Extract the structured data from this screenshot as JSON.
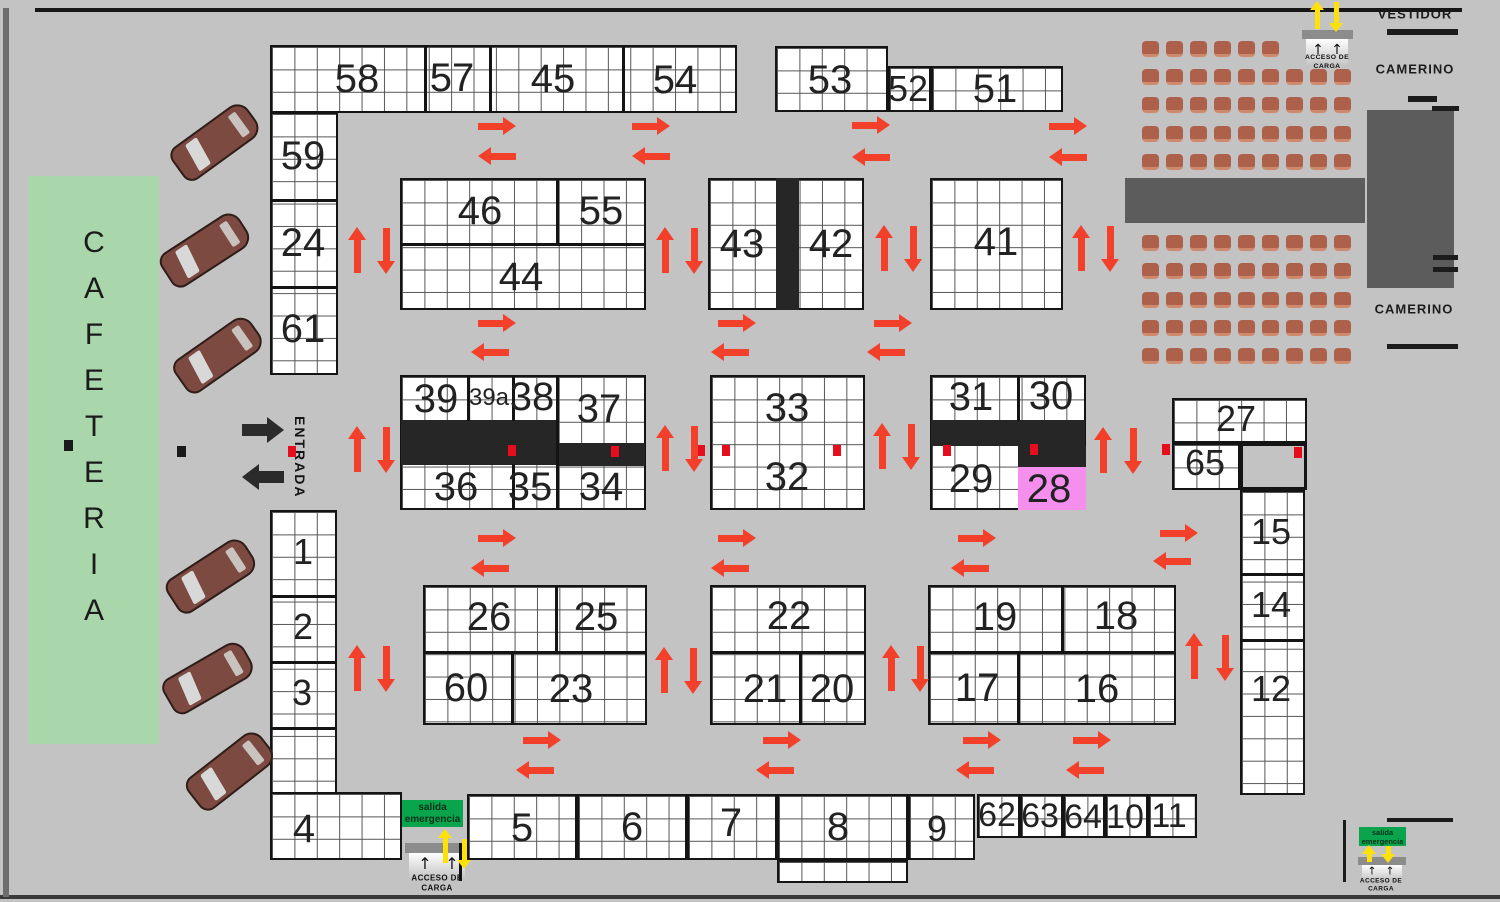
{
  "labels": {
    "cafeteria": "CAFETERIA",
    "entrance": "ENTRADA",
    "vestidor": "VESTIDOR",
    "camerino_top": "CAMERINO",
    "camerino_bottom": "CAMERINO",
    "exit_line1": "salida",
    "exit_line2": "emergencia",
    "loading_line1": "ACCESO DE",
    "loading_line2": "CARGA"
  },
  "colors": {
    "background": "#c3c3c3",
    "grid_cell": "#ffffff",
    "grid_line": "#565656",
    "block_border": "#141414",
    "black_bar": "#262626",
    "stall_28": "#f58fee",
    "aisle_arrow": "#f2402b",
    "marker_red": "#e60e1c",
    "marker_black": "#1a1a1a",
    "exit_sign": "#0aa44d",
    "exit_arrow": "#ffe10a",
    "cafeteria": "#a9d6aa",
    "chair": "#ae614a",
    "stage": "#5c5c5c"
  },
  "plan": {
    "blocks": [
      [
        270,
        45,
        467,
        68
      ],
      [
        270,
        112,
        68,
        263
      ],
      [
        775,
        46,
        113,
        66
      ],
      [
        888,
        66,
        43,
        46
      ],
      [
        931,
        66,
        132,
        46
      ],
      [
        400,
        178,
        246,
        132
      ],
      [
        708,
        178,
        156,
        132
      ],
      [
        930,
        178,
        133,
        132
      ],
      [
        400,
        375,
        246,
        135
      ],
      [
        710,
        375,
        155,
        135
      ],
      [
        930,
        375,
        156,
        135
      ],
      [
        1172,
        398,
        135,
        45
      ],
      [
        1172,
        443,
        68,
        47
      ],
      [
        1240,
        490,
        65,
        305
      ],
      [
        270,
        510,
        67,
        284
      ],
      [
        270,
        792,
        132,
        68
      ],
      [
        423,
        585,
        224,
        140
      ],
      [
        710,
        585,
        156,
        140
      ],
      [
        928,
        585,
        248,
        140
      ],
      [
        467,
        794,
        110,
        66
      ],
      [
        577,
        794,
        110,
        66
      ],
      [
        687,
        794,
        90,
        66
      ],
      [
        777,
        794,
        131,
        66
      ],
      [
        777,
        860,
        131,
        23
      ],
      [
        908,
        794,
        67,
        66
      ],
      [
        977,
        794,
        43,
        44
      ],
      [
        1020,
        794,
        43,
        44
      ],
      [
        1063,
        794,
        42,
        44
      ],
      [
        1105,
        794,
        43,
        44
      ],
      [
        1148,
        794,
        49,
        44
      ]
    ],
    "gray_blocks": [
      [
        1240,
        443,
        67,
        47
      ]
    ],
    "solids": [
      [
        776,
        178,
        23,
        132
      ],
      [
        401,
        420,
        156,
        45
      ],
      [
        557,
        443,
        88,
        23
      ],
      [
        931,
        420,
        154,
        26
      ],
      [
        1018,
        446,
        68,
        21
      ]
    ],
    "pinks": [
      [
        1018,
        467,
        68,
        43
      ]
    ],
    "dividers": [
      [
        424,
        45,
        3,
        68
      ],
      [
        489,
        45,
        3,
        68
      ],
      [
        622,
        45,
        3,
        68
      ],
      [
        270,
        199,
        68,
        3
      ],
      [
        270,
        286,
        68,
        3
      ],
      [
        556,
        178,
        3,
        67
      ],
      [
        400,
        243,
        246,
        3
      ],
      [
        467,
        375,
        3,
        46
      ],
      [
        512,
        375,
        3,
        46
      ],
      [
        556,
        375,
        3,
        135
      ],
      [
        512,
        464,
        3,
        46
      ],
      [
        1017,
        375,
        3,
        46
      ],
      [
        1240,
        573,
        65,
        3
      ],
      [
        1240,
        639,
        65,
        3
      ],
      [
        270,
        595,
        67,
        3
      ],
      [
        270,
        661,
        67,
        3
      ],
      [
        270,
        727,
        67,
        3
      ],
      [
        423,
        651,
        224,
        3
      ],
      [
        555,
        585,
        3,
        67
      ],
      [
        511,
        651,
        3,
        74
      ],
      [
        710,
        651,
        156,
        3
      ],
      [
        799,
        651,
        3,
        74
      ],
      [
        928,
        651,
        248,
        3
      ],
      [
        1061,
        585,
        3,
        67
      ],
      [
        1017,
        651,
        3,
        74
      ]
    ],
    "stalls": [
      {
        "n": "58",
        "x": 357,
        "y": 79
      },
      {
        "n": "57",
        "x": 452,
        "y": 78
      },
      {
        "n": "45",
        "x": 553,
        "y": 79
      },
      {
        "n": "54",
        "x": 675,
        "y": 80
      },
      {
        "n": "53",
        "x": 830,
        "y": 80
      },
      {
        "n": "52",
        "x": 908,
        "y": 89,
        "s": 36
      },
      {
        "n": "51",
        "x": 995,
        "y": 89
      },
      {
        "n": "59",
        "x": 303,
        "y": 156
      },
      {
        "n": "24",
        "x": 303,
        "y": 243
      },
      {
        "n": "61",
        "x": 303,
        "y": 329
      },
      {
        "n": "46",
        "x": 480,
        "y": 211
      },
      {
        "n": "55",
        "x": 601,
        "y": 211
      },
      {
        "n": "44",
        "x": 521,
        "y": 277
      },
      {
        "n": "43",
        "x": 742,
        "y": 244
      },
      {
        "n": "42",
        "x": 831,
        "y": 244
      },
      {
        "n": "41",
        "x": 996,
        "y": 242
      },
      {
        "n": "39",
        "x": 436,
        "y": 399
      },
      {
        "n": "39a",
        "x": 489,
        "y": 398,
        "s": 24
      },
      {
        "n": "38",
        "x": 532,
        "y": 397
      },
      {
        "n": "37",
        "x": 599,
        "y": 409
      },
      {
        "n": "36",
        "x": 456,
        "y": 487
      },
      {
        "n": "35",
        "x": 530,
        "y": 487
      },
      {
        "n": "34",
        "x": 601,
        "y": 487
      },
      {
        "n": "33",
        "x": 787,
        "y": 408
      },
      {
        "n": "32",
        "x": 787,
        "y": 477
      },
      {
        "n": "31",
        "x": 971,
        "y": 397
      },
      {
        "n": "30",
        "x": 1051,
        "y": 396
      },
      {
        "n": "29",
        "x": 971,
        "y": 479
      },
      {
        "n": "28",
        "x": 1049,
        "y": 489
      },
      {
        "n": "27",
        "x": 1236,
        "y": 419,
        "s": 36
      },
      {
        "n": "65",
        "x": 1205,
        "y": 463,
        "s": 36
      },
      {
        "n": "15",
        "x": 1271,
        "y": 532,
        "s": 36
      },
      {
        "n": "14",
        "x": 1271,
        "y": 605,
        "s": 36
      },
      {
        "n": "12",
        "x": 1271,
        "y": 689,
        "s": 36
      },
      {
        "n": "1",
        "x": 303,
        "y": 552,
        "s": 36
      },
      {
        "n": "2",
        "x": 303,
        "y": 627,
        "s": 36
      },
      {
        "n": "3",
        "x": 302,
        "y": 693,
        "s": 36
      },
      {
        "n": "4",
        "x": 304,
        "y": 829
      },
      {
        "n": "26",
        "x": 489,
        "y": 617
      },
      {
        "n": "25",
        "x": 596,
        "y": 617
      },
      {
        "n": "60",
        "x": 466,
        "y": 688
      },
      {
        "n": "23",
        "x": 571,
        "y": 689
      },
      {
        "n": "22",
        "x": 789,
        "y": 616
      },
      {
        "n": "21",
        "x": 765,
        "y": 689
      },
      {
        "n": "20",
        "x": 832,
        "y": 689
      },
      {
        "n": "19",
        "x": 995,
        "y": 617
      },
      {
        "n": "18",
        "x": 1116,
        "y": 616
      },
      {
        "n": "17",
        "x": 977,
        "y": 688
      },
      {
        "n": "16",
        "x": 1097,
        "y": 689
      },
      {
        "n": "5",
        "x": 522,
        "y": 828
      },
      {
        "n": "6",
        "x": 632,
        "y": 827
      },
      {
        "n": "7",
        "x": 731,
        "y": 823
      },
      {
        "n": "8",
        "x": 838,
        "y": 827
      },
      {
        "n": "9",
        "x": 937,
        "y": 829,
        "s": 36
      },
      {
        "n": "62",
        "x": 997,
        "y": 815,
        "s": 34
      },
      {
        "n": "63",
        "x": 1040,
        "y": 816,
        "s": 34
      },
      {
        "n": "64",
        "x": 1083,
        "y": 817,
        "s": 34
      },
      {
        "n": "10",
        "x": 1125,
        "y": 817,
        "s": 34
      },
      {
        "n": "11",
        "x": 1169,
        "y": 816,
        "s": 34
      }
    ],
    "red_squares": [
      [
        288,
        446
      ],
      [
        508,
        445
      ],
      [
        611,
        446
      ],
      [
        697,
        445
      ],
      [
        722,
        445
      ],
      [
        833,
        445
      ],
      [
        943,
        445
      ],
      [
        1030,
        444
      ],
      [
        1162,
        444
      ],
      [
        1294,
        447
      ]
    ],
    "black_squares": [
      [
        64,
        440
      ],
      [
        177,
        446
      ]
    ],
    "red_arrows": [
      [
        "right",
        497,
        126
      ],
      [
        "right",
        651,
        126
      ],
      [
        "right",
        871,
        125
      ],
      [
        "right",
        1068,
        126
      ],
      [
        "left",
        497,
        156
      ],
      [
        "left",
        651,
        156
      ],
      [
        "left",
        871,
        157
      ],
      [
        "left",
        1068,
        157
      ],
      [
        "right",
        497,
        323
      ],
      [
        "right",
        737,
        323
      ],
      [
        "right",
        893,
        323
      ],
      [
        "left",
        490,
        352
      ],
      [
        "left",
        730,
        352
      ],
      [
        "left",
        886,
        352
      ],
      [
        "up",
        357,
        250
      ],
      [
        "down",
        386,
        251
      ],
      [
        "up",
        665,
        250
      ],
      [
        "down",
        694,
        251
      ],
      [
        "up",
        884,
        248
      ],
      [
        "down",
        913,
        249
      ],
      [
        "up",
        1081,
        248
      ],
      [
        "down",
        1110,
        249
      ],
      [
        "up",
        357,
        449
      ],
      [
        "down",
        386,
        450
      ],
      [
        "up",
        665,
        448
      ],
      [
        "down",
        694,
        449
      ],
      [
        "up",
        882,
        446
      ],
      [
        "down",
        911,
        447
      ],
      [
        "up",
        1103,
        450
      ],
      [
        "down",
        1133,
        451
      ],
      [
        "right",
        497,
        538
      ],
      [
        "right",
        737,
        538
      ],
      [
        "right",
        977,
        538
      ],
      [
        "right",
        1179,
        533
      ],
      [
        "left",
        490,
        568
      ],
      [
        "left",
        730,
        568
      ],
      [
        "left",
        970,
        568
      ],
      [
        "left",
        1172,
        561
      ],
      [
        "up",
        357,
        668
      ],
      [
        "down",
        386,
        669
      ],
      [
        "up",
        664,
        670
      ],
      [
        "down",
        693,
        671
      ],
      [
        "up",
        891,
        668
      ],
      [
        "down",
        920,
        669
      ],
      [
        "up",
        1194,
        656
      ],
      [
        "down",
        1225,
        658
      ],
      [
        "right",
        542,
        740
      ],
      [
        "right",
        782,
        740
      ],
      [
        "right",
        982,
        740
      ],
      [
        "right",
        1092,
        740
      ],
      [
        "left",
        535,
        770
      ],
      [
        "left",
        775,
        770
      ],
      [
        "left",
        975,
        770
      ],
      [
        "left",
        1085,
        770
      ]
    ],
    "black_arrows": [
      [
        "right",
        263,
        430
      ],
      [
        "left",
        263,
        477
      ]
    ],
    "yellow_arrows": [
      [
        "up",
        1317,
        15,
        28
      ],
      [
        "down",
        1336,
        17,
        30
      ],
      [
        "up",
        445,
        846,
        34
      ],
      [
        "down",
        464,
        854,
        30
      ],
      [
        "up",
        1369,
        853,
        17
      ],
      [
        "down",
        1388,
        854,
        17
      ]
    ],
    "chair_cols": [
      1142,
      1166,
      1190,
      1214,
      1238,
      1262,
      1286,
      1310,
      1334
    ],
    "chair_rows": [
      {
        "y": 41,
        "n": 6
      },
      {
        "y": 69,
        "n": 9
      },
      {
        "y": 97,
        "n": 9
      },
      {
        "y": 126,
        "n": 9
      },
      {
        "y": 154,
        "n": 9
      },
      {
        "y": 235,
        "n": 9
      },
      {
        "y": 263,
        "n": 9
      },
      {
        "y": 292,
        "n": 9
      },
      {
        "y": 320,
        "n": 9
      },
      {
        "y": 348,
        "n": 9
      }
    ],
    "cars": [
      {
        "x": 215,
        "y": 142,
        "r": -36
      },
      {
        "x": 205,
        "y": 250,
        "r": -33
      },
      {
        "x": 218,
        "y": 355,
        "r": -35
      },
      {
        "x": 211,
        "y": 576,
        "r": -33
      },
      {
        "x": 208,
        "y": 678,
        "r": -30
      },
      {
        "x": 230,
        "y": 771,
        "r": -38
      }
    ],
    "stage": [
      [
        1125,
        178,
        240,
        45
      ],
      [
        1367,
        110,
        87,
        178
      ]
    ],
    "lines": [
      [
        35,
        8,
        1427,
        4,
        "#161616"
      ],
      [
        0,
        895,
        1500,
        4,
        "#3a3a3a"
      ],
      [
        3,
        8,
        6,
        889,
        "#6d6d6d"
      ],
      [
        1387,
        29,
        71,
        6,
        "#1c1c1c"
      ],
      [
        1387,
        344,
        71,
        5,
        "#1c1c1c"
      ],
      [
        1408,
        96,
        29,
        6,
        "#1c1c1c"
      ],
      [
        1432,
        106,
        27,
        5,
        "#1c1c1c"
      ],
      [
        1433,
        255,
        25,
        5,
        "#1c1c1c"
      ],
      [
        1433,
        267,
        25,
        5,
        "#1c1c1c"
      ],
      [
        1387,
        818,
        66,
        4,
        "#1c1c1c"
      ],
      [
        1343,
        820,
        3,
        62,
        "#1c1c1c"
      ],
      [
        459,
        843,
        3,
        38,
        "#111111"
      ]
    ]
  }
}
